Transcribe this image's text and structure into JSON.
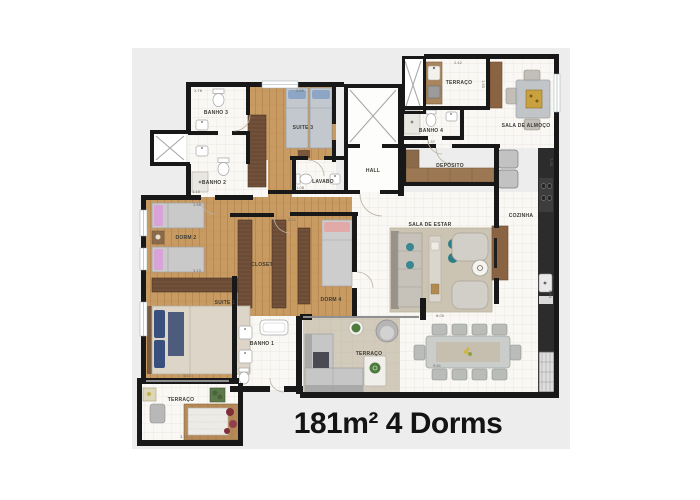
{
  "caption": "181m² 4 Dorms",
  "rooms": {
    "banho3": "BANHO 3",
    "suite3": "SUITE 3",
    "banho2": "BANHO 2",
    "lavabo": "LAVABO",
    "hall": "HALL",
    "banho4": "BANHO 4",
    "terraco_top": "TERRAÇO",
    "sala_almoco": "SALA DE ALMOÇO",
    "deposito": "DEPÓSITO",
    "cozinha": "COZINHA",
    "sala_estar": "SALA DE ESTAR",
    "dorm2": "DORM 2",
    "closet": "CLOSET",
    "dorm4": "DORM 4",
    "suite1": "SUITE 1",
    "banho1": "BANHO 1",
    "terraco_living": "TERRAÇO",
    "terraco_suite": "TERRAÇO"
  },
  "dimensions": {
    "banho3_w": "2.76",
    "suite3_w": "2.85",
    "banho2_w": "1.10",
    "lavabo_w": "1.08",
    "terraco_top_w": "2.42",
    "terraco_top_h": "1.65",
    "banho4_w": "1.37",
    "right_upper_h": "7.05",
    "right_mid_h": "4.54",
    "closet_w": "2.21",
    "dorm2_top_w": "2.86",
    "dorm2_bottom_w": "3.15",
    "sala_estar_w": "6.00",
    "dining_w": "9.61",
    "suite1_w": "5.10",
    "terraco_suite_w": "3.71"
  },
  "colors": {
    "page_bg": "#ffffff",
    "panel_bg": "#ededed",
    "wall": "#181818",
    "tile_floor": "#faf8f4",
    "wood_floor": "#c89b63",
    "stone_floor": "#d2cbbc",
    "rug": "#ccc4b2",
    "wardrobe": "#6b4b35",
    "accent_teal": "#2f7d88",
    "pillow_pink": "#d9a2d9",
    "pillow_navy": "#39507e",
    "caption_text": "#141414"
  }
}
